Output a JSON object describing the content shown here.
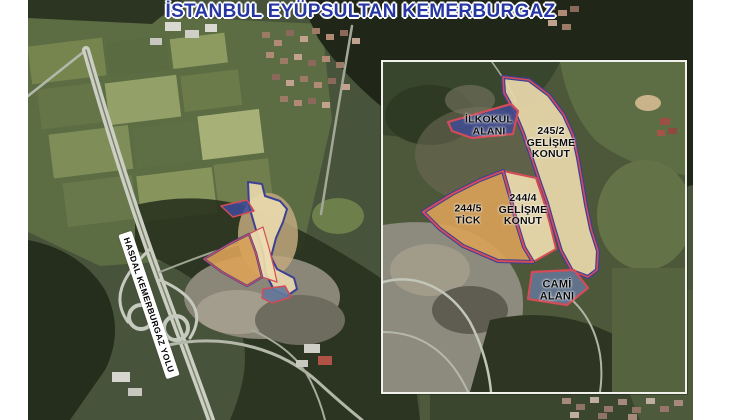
{
  "title": "İSTANBUL EYÜPSULTAN KEMERBURGAZ",
  "main_map": {
    "road_label": "HASDAL KEMERBURGAZ YOLU",
    "parcel_ids": [
      "ilkokul-alani",
      "245-2-gelisme-konut",
      "244-4-gelisme-konut",
      "244-5-tick",
      "cami-alani"
    ]
  },
  "inset": {
    "parcels": [
      {
        "id": "ilkokul-alani",
        "label": "İLKOKUL ALANI",
        "lines": [
          "İLKOKUL",
          "ALANI"
        ],
        "fill": "#3e4a9a",
        "border": "#d34c57"
      },
      {
        "id": "245-2-gelisme-konut",
        "label": "245/2 GELİŞME KONUT",
        "lines": [
          "245/2",
          "GELİŞME",
          "KONUT"
        ],
        "fill": "#ead9ad",
        "border": "#3c4094"
      },
      {
        "id": "244-4-gelisme-konut",
        "label": "244/4 GELİŞME KONUT",
        "lines": [
          "244/4",
          "GELİŞME",
          "KONUT"
        ],
        "fill": "#eedcb0",
        "border": "#d34c57"
      },
      {
        "id": "244-5-tick",
        "label": "244/5 TİCK",
        "lines": [
          "244/5",
          "TİCK"
        ],
        "fill": "#daa258",
        "border": "#d34c57"
      },
      {
        "id": "cami-alani",
        "label": "CAMİ ALANI",
        "lines": [
          "CAMİ",
          "ALANI"
        ],
        "fill": "#64789a",
        "border": "#d34c57"
      }
    ]
  },
  "colors": {
    "title_blue": "#2636a3",
    "parcel_border_red": "#d34c57",
    "parcel_border_blue": "#3c4094",
    "inset_frame": "#f1f1ec"
  }
}
